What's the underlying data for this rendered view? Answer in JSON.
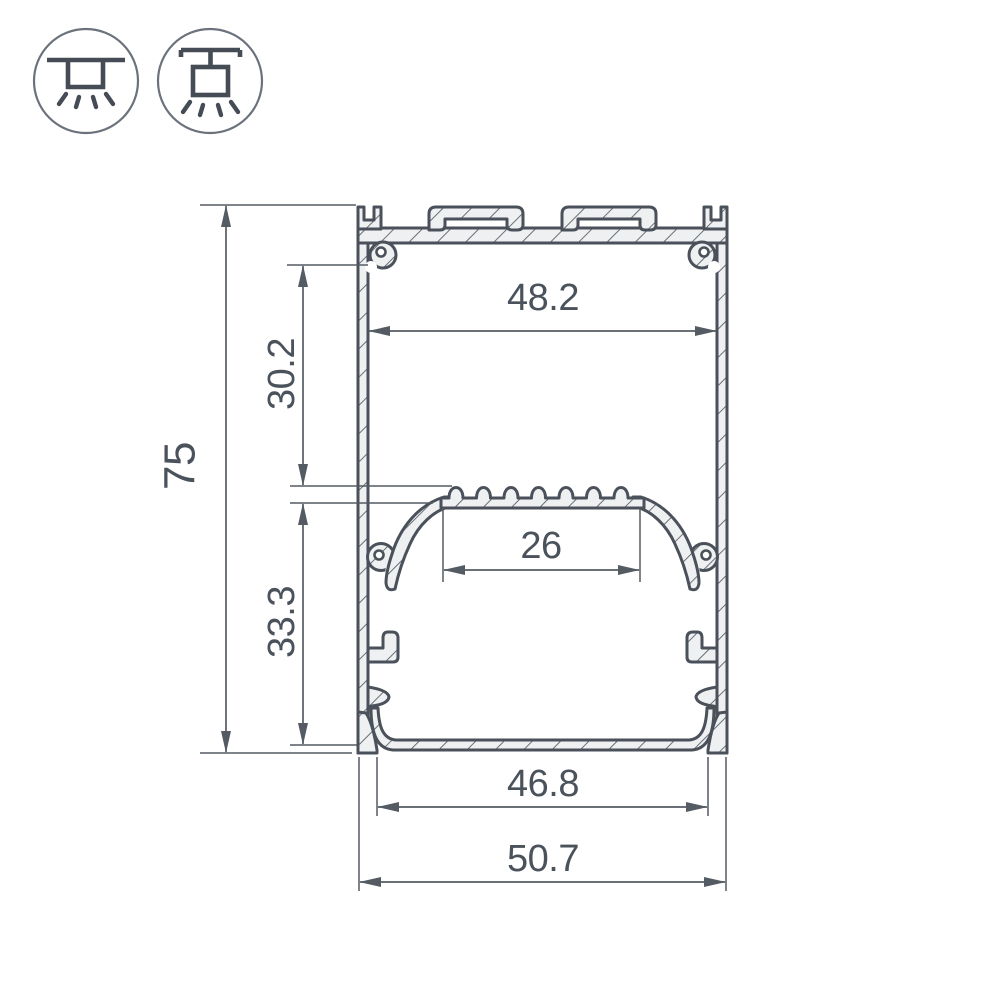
{
  "page": {
    "background": "#ffffff",
    "description": "Technical cross-section drawing of an aluminium LED profile with mounting-type icons"
  },
  "legend_icons": {
    "surface_mount": {
      "name": "surface-mount-light-icon"
    },
    "pendant_mount": {
      "name": "pendant-mount-light-icon"
    }
  },
  "drawing": {
    "type": "profile-cross-section",
    "colors": {
      "outline": "#4a515a",
      "dimension": "#545b63",
      "material_fill": "#eef0f1",
      "background": "#ffffff"
    },
    "dimensions": {
      "overall_height_mm": "75",
      "top_cavity_height_mm": "30.2",
      "bottom_cavity_height_mm": "33.3",
      "inner_width_mm": "48.2",
      "led_shelf_width_mm": "26",
      "bottom_opening_width_mm": "46.8",
      "overall_width_mm": "50.7"
    }
  }
}
